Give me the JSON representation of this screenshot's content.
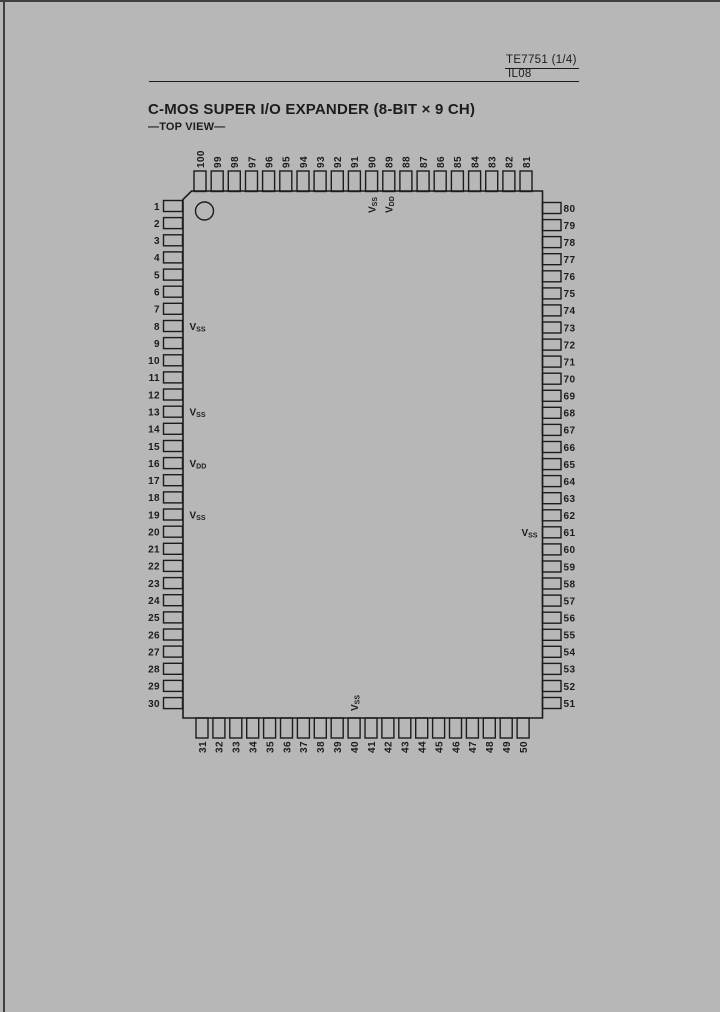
{
  "header": {
    "doc_ref": "TE7751 (1/4)",
    "page_code": "IL08"
  },
  "title": "C-MOS SUPER I/O EXPANDER (8-BIT × 9 CH)",
  "view_label": "—TOP VIEW—",
  "colors": {
    "background": "#b7b7b7",
    "ink": "#1c1c1c"
  },
  "icons": {
    "pin_one_indicator": "circle"
  },
  "chip": {
    "pins": {
      "top": [
        "100",
        "99",
        "98",
        "97",
        "96",
        "95",
        "94",
        "93",
        "92",
        "91",
        "90",
        "89",
        "88",
        "87",
        "86",
        "85",
        "84",
        "83",
        "82",
        "81"
      ],
      "left": [
        "1",
        "2",
        "3",
        "4",
        "5",
        "6",
        "7",
        "8",
        "9",
        "10",
        "11",
        "12",
        "13",
        "14",
        "15",
        "16",
        "17",
        "18",
        "19",
        "20",
        "21",
        "22",
        "23",
        "24",
        "25",
        "26",
        "27",
        "28",
        "29",
        "30"
      ],
      "right": [
        "80",
        "79",
        "78",
        "77",
        "76",
        "75",
        "74",
        "73",
        "72",
        "71",
        "70",
        "69",
        "68",
        "67",
        "66",
        "65",
        "64",
        "63",
        "62",
        "61",
        "60",
        "59",
        "58",
        "57",
        "56",
        "55",
        "54",
        "53",
        "52",
        "51"
      ],
      "bottom": [
        "31",
        "32",
        "33",
        "34",
        "35",
        "36",
        "37",
        "38",
        "39",
        "40",
        "41",
        "42",
        "43",
        "44",
        "45",
        "46",
        "47",
        "48",
        "49",
        "50"
      ]
    },
    "power_labels": [
      {
        "pin": 90,
        "side": "top",
        "base": "V",
        "sub": "SS"
      },
      {
        "pin": 89,
        "side": "top",
        "base": "V",
        "sub": "DD"
      },
      {
        "pin": 8,
        "side": "left",
        "base": "V",
        "sub": "SS"
      },
      {
        "pin": 13,
        "side": "left",
        "base": "V",
        "sub": "SS"
      },
      {
        "pin": 16,
        "side": "left",
        "base": "V",
        "sub": "DD"
      },
      {
        "pin": 19,
        "side": "left",
        "base": "V",
        "sub": "SS"
      },
      {
        "pin": 61,
        "side": "right",
        "base": "V",
        "sub": "SS"
      },
      {
        "pin": 40,
        "side": "bottom",
        "base": "V",
        "sub": "SS"
      }
    ]
  }
}
